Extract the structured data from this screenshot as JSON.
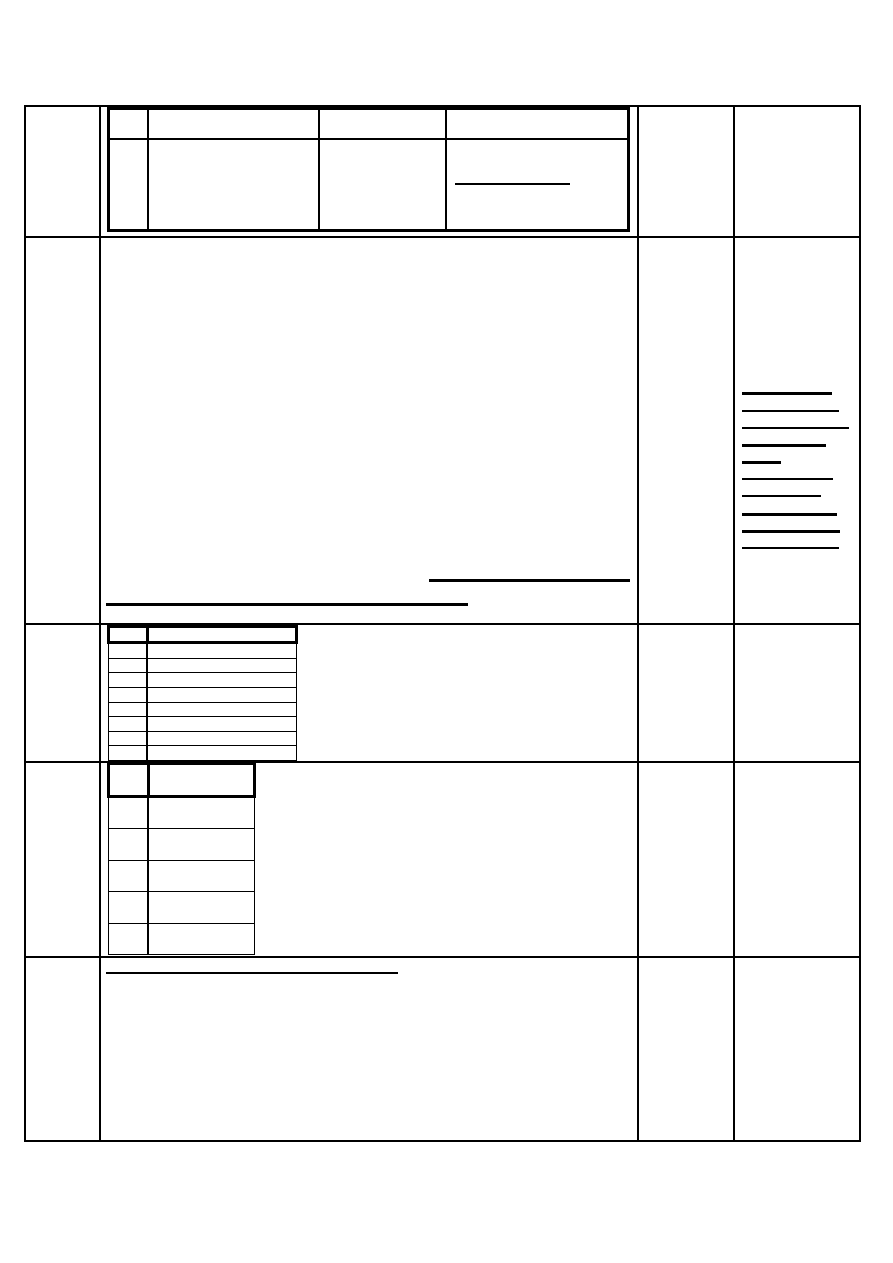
{
  "document": {
    "kind": "blank-form-template",
    "background": "#ffffff",
    "line_color": "#000000",
    "visible_text": ""
  },
  "grid": {
    "columns": 4,
    "rows": 5
  },
  "header_table": {
    "columns": 4,
    "rows": 2,
    "underline": [
      {
        "x": 345,
        "y": 73,
        "w": 115,
        "t": 1.5
      }
    ]
  },
  "main_underlines": [
    {
      "x": 403,
      "y": 472,
      "w": 201,
      "t": 3
    },
    {
      "x": 80,
      "y": 496,
      "w": 362,
      "t": 3
    }
  ],
  "notes_lines": [
    {
      "x": 716,
      "y": 285,
      "w": 90,
      "t": 3
    },
    {
      "x": 716,
      "y": 303,
      "w": 97,
      "t": 1.5
    },
    {
      "x": 716,
      "y": 320,
      "w": 107,
      "t": 1.5
    },
    {
      "x": 716,
      "y": 337,
      "w": 84,
      "t": 3
    },
    {
      "x": 716,
      "y": 354,
      "w": 39,
      "t": 3
    },
    {
      "x": 716,
      "y": 371,
      "w": 91,
      "t": 1.5
    },
    {
      "x": 716,
      "y": 388,
      "w": 79,
      "t": 1.5
    },
    {
      "x": 716,
      "y": 406,
      "w": 95,
      "t": 3
    },
    {
      "x": 716,
      "y": 423,
      "w": 98,
      "t": 3
    },
    {
      "x": 716,
      "y": 440,
      "w": 97,
      "t": 1.5
    }
  ],
  "list_table": {
    "columns": 2,
    "body_rows": 8
  },
  "grade_table": {
    "columns": 2,
    "body_rows": 5
  },
  "footer_underline": [
    {
      "x": 80,
      "y": 865,
      "w": 292,
      "t": 2
    }
  ]
}
